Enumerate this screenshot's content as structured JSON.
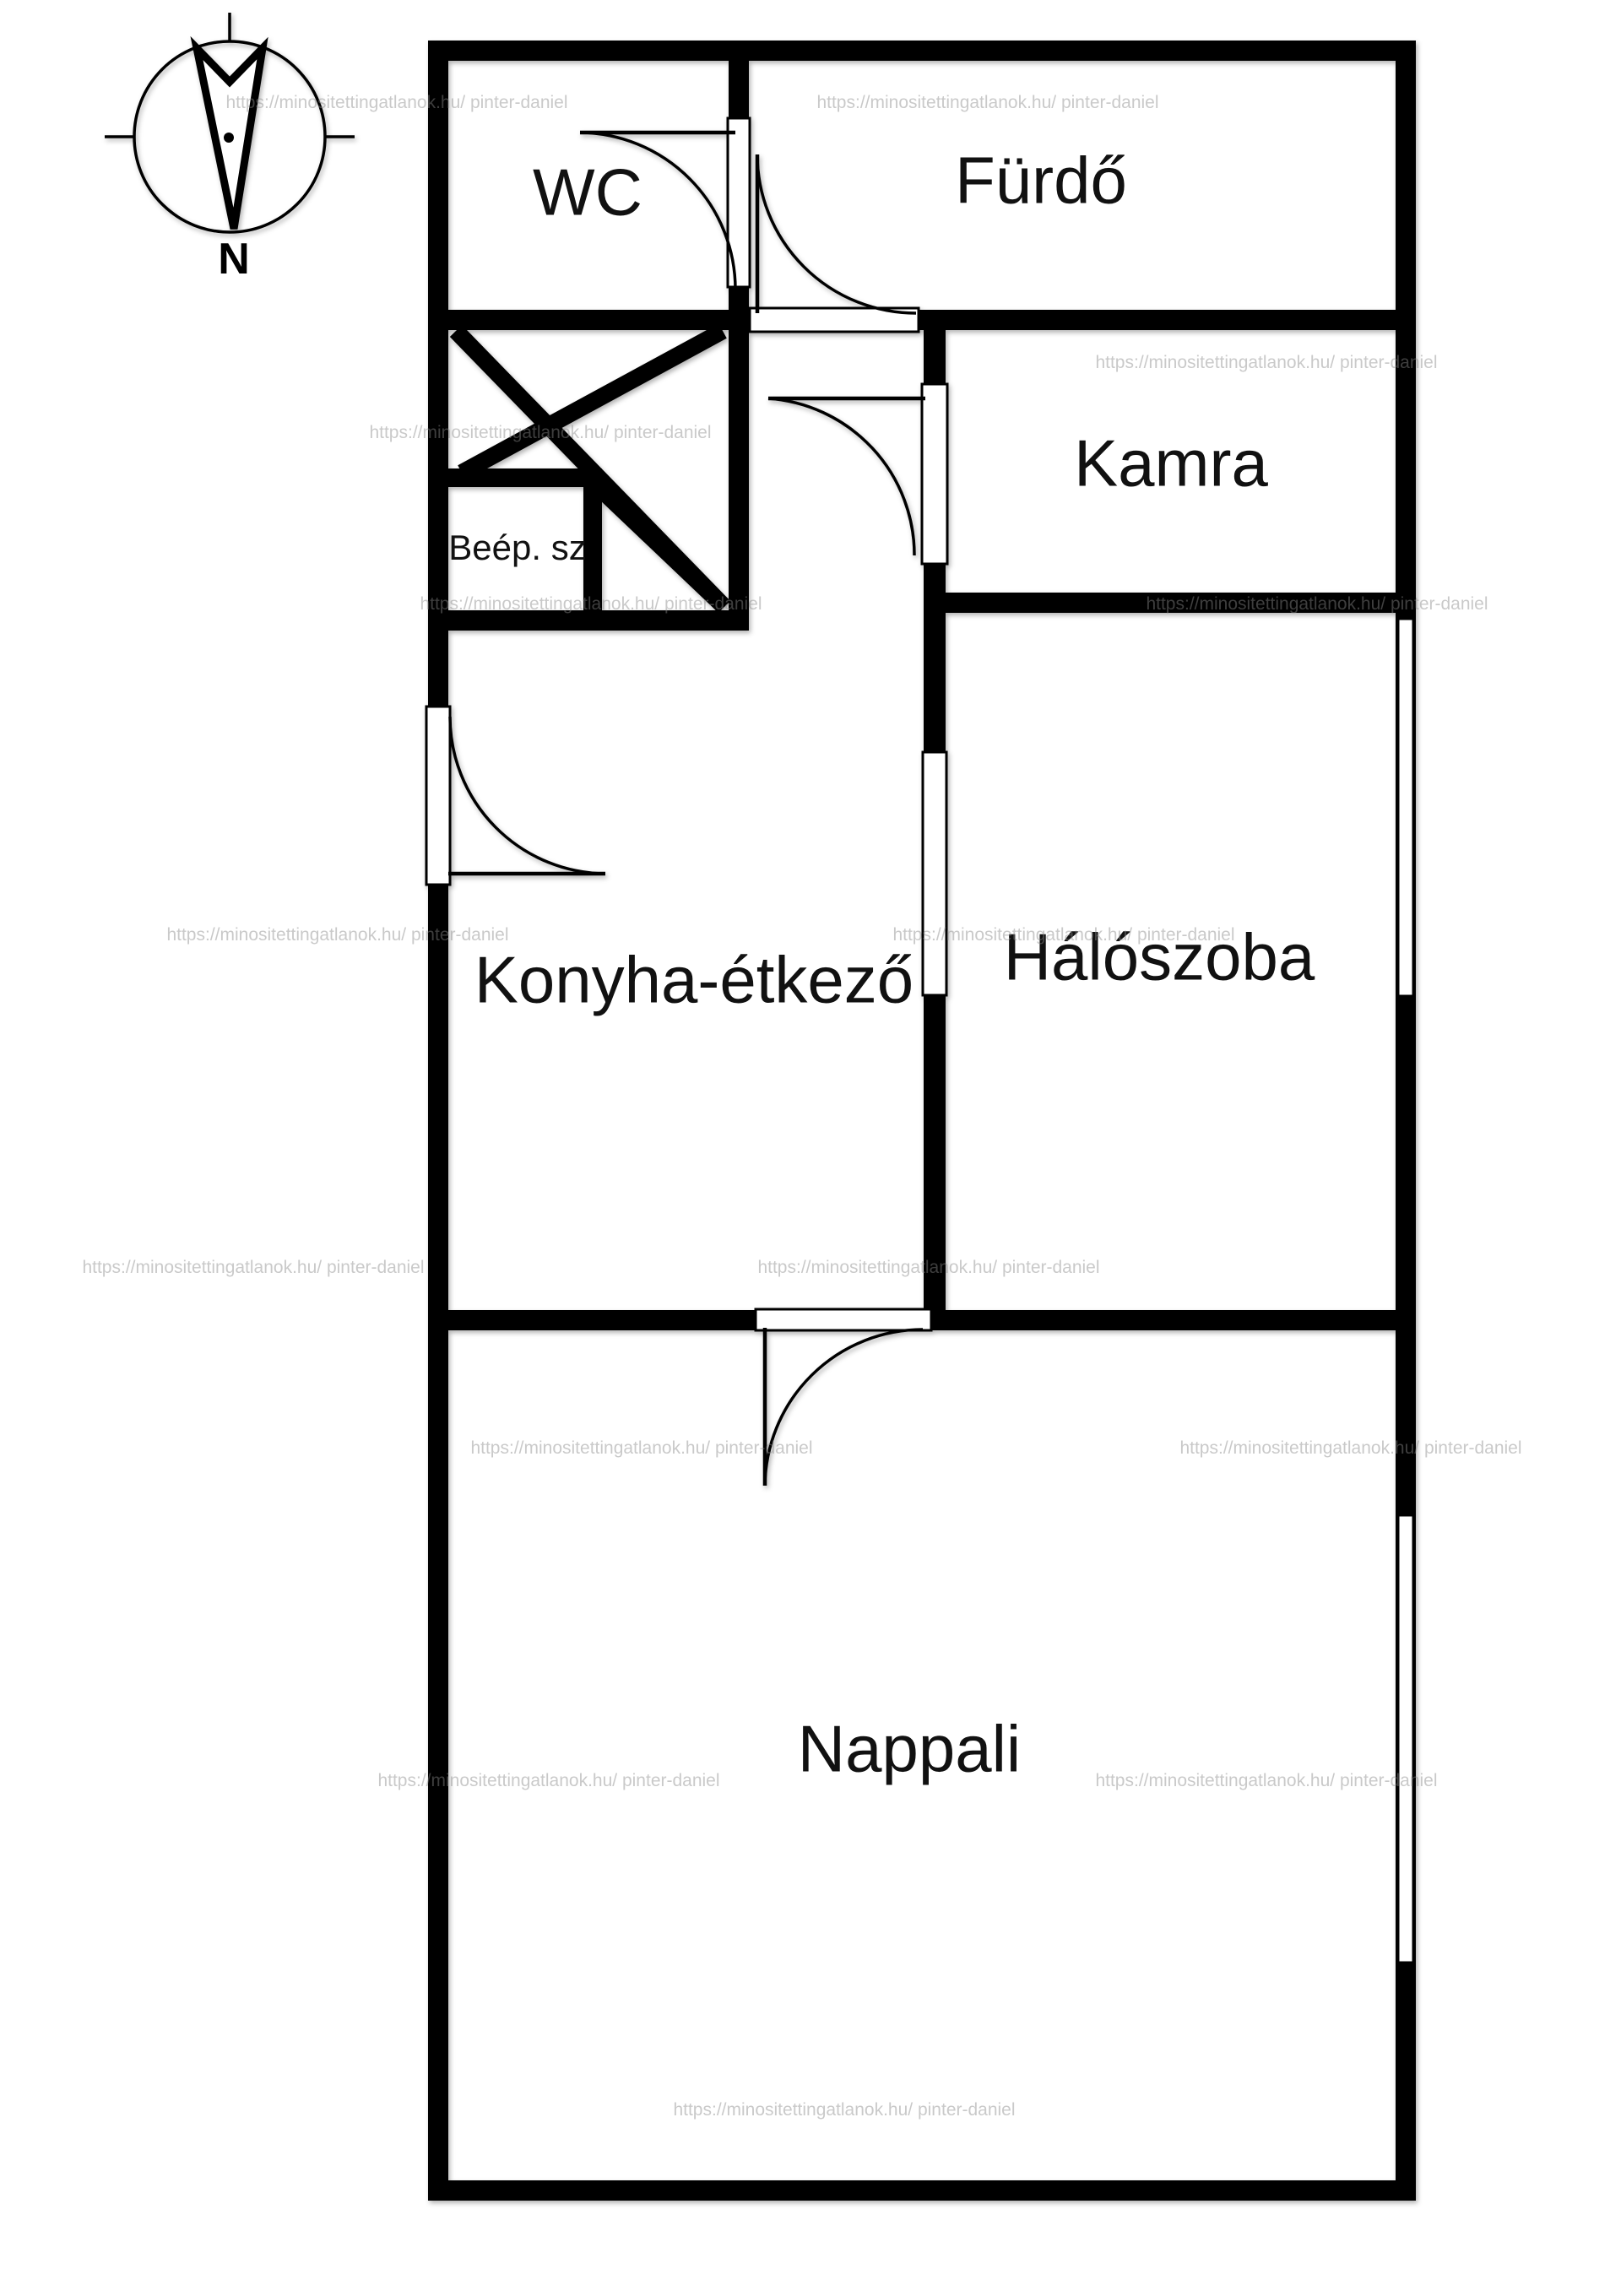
{
  "compass": {
    "north_label": "N"
  },
  "rooms": {
    "wc": {
      "label": "WC"
    },
    "furdo": {
      "label": "Fürdő"
    },
    "kamra": {
      "label": "Kamra"
    },
    "beep_sz": {
      "label": "Beép. sz"
    },
    "konyha": {
      "label": "Konyha-étkező"
    },
    "halo": {
      "label": "Hálószoba"
    },
    "nappali": {
      "label": "Nappali"
    }
  },
  "watermark": {
    "text": "https://minositettingatlanok.hu/ pinter-daniel"
  },
  "colors": {
    "wall": "#000000",
    "background": "#ffffff",
    "watermark": "#8a8a8a"
  }
}
